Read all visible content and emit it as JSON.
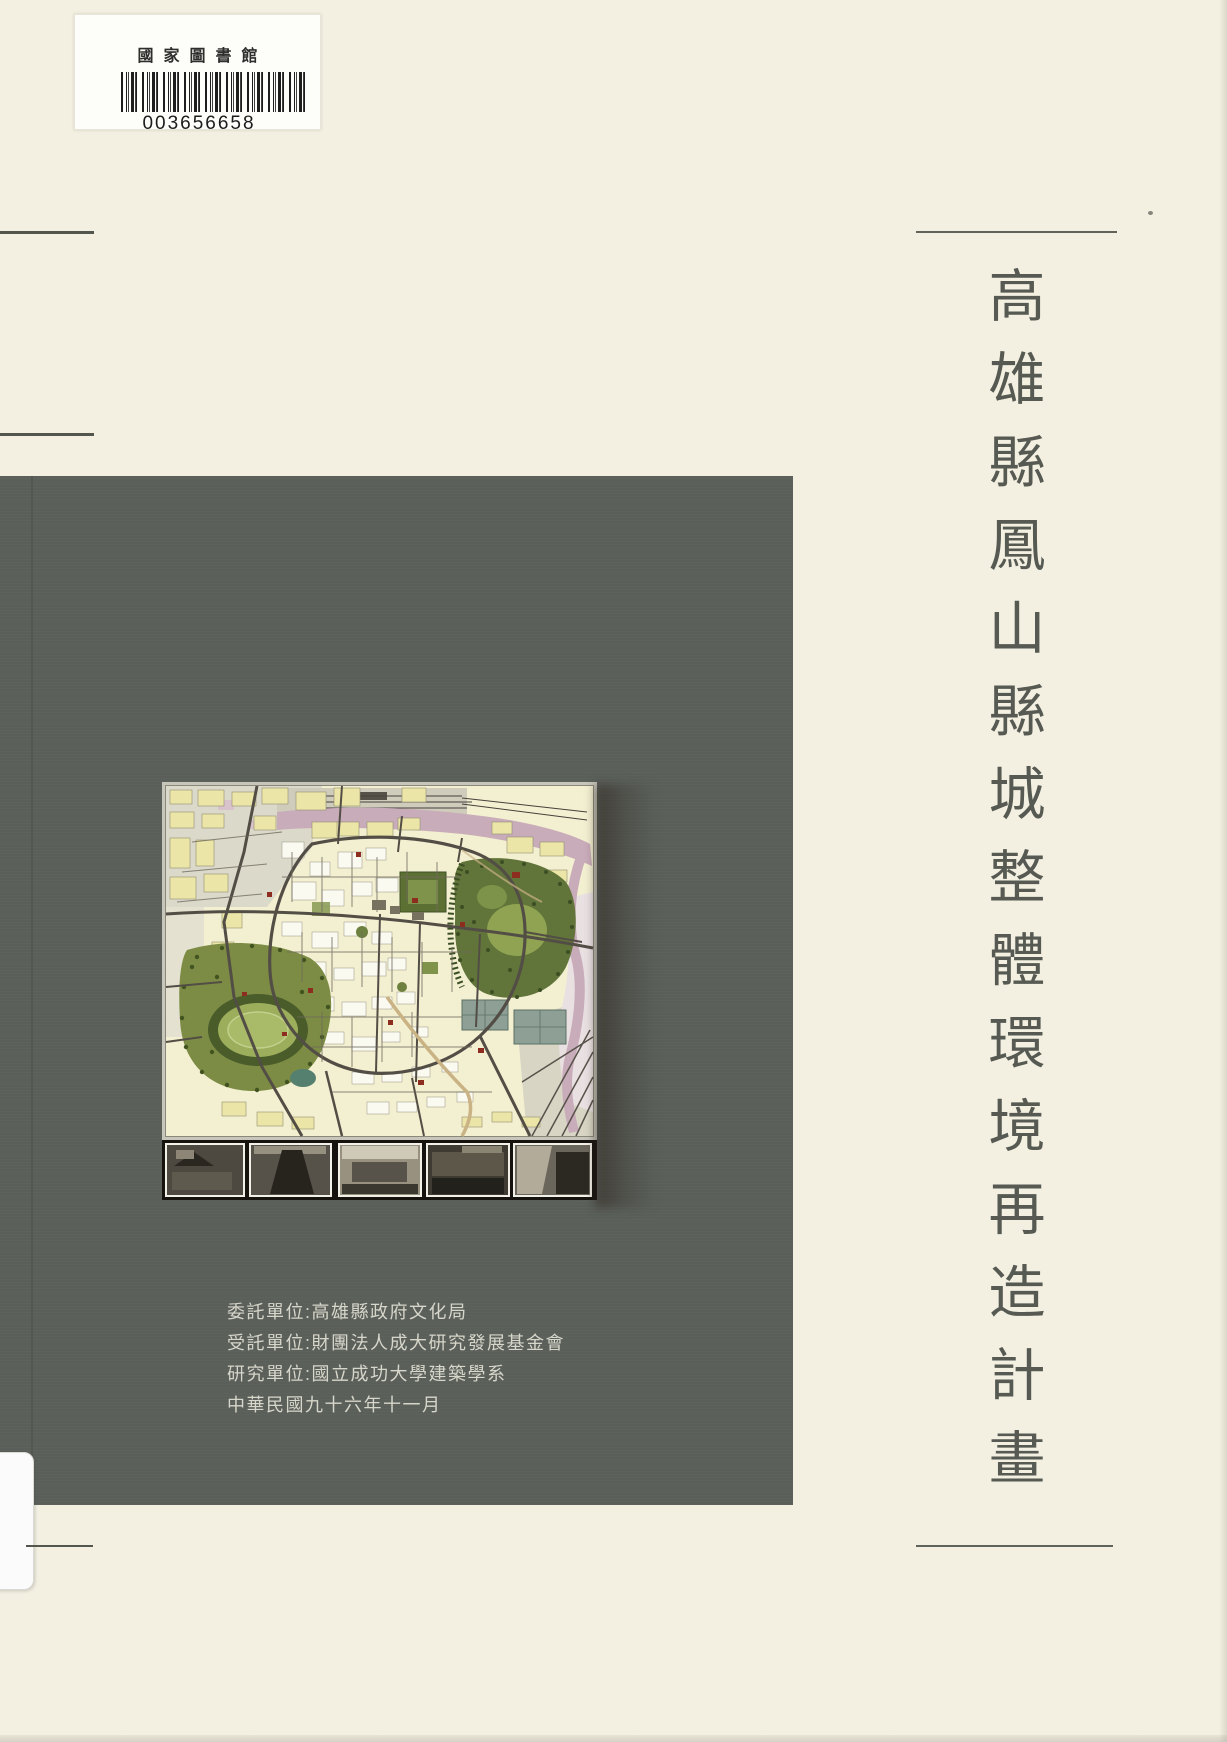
{
  "page": {
    "background_color": "#f3f0e2",
    "panel_color": "#5a5f5a",
    "title_color": "#565a52",
    "credits_color": "#d7d6ca"
  },
  "library_label": {
    "institution_name": "國家圖書館",
    "barcode_number": "003656658"
  },
  "cover_title": {
    "text": "高雄縣鳳山縣城整體環境再造計畫"
  },
  "credits": {
    "lines": [
      "委託單位:高雄縣政府文化局",
      "受託單位:財團法人成大研究發展基金會",
      "研究單位:國立成功大學建築學系",
      "中華民國九十六年十一月"
    ]
  },
  "map_figure": {
    "description": "land-use plan map of Fengshan old county city with strip of five site photos",
    "photo_count": 5,
    "colors": {
      "blocks_yellow": "#ece5a8",
      "roads_dark": "#534e45",
      "park_green": "#61743a",
      "river_pink": "#c9acba",
      "stadium_green": "#9cae5c",
      "photo_strip_bg": "#16130f",
      "historic_red": "#8d2d1f"
    }
  }
}
